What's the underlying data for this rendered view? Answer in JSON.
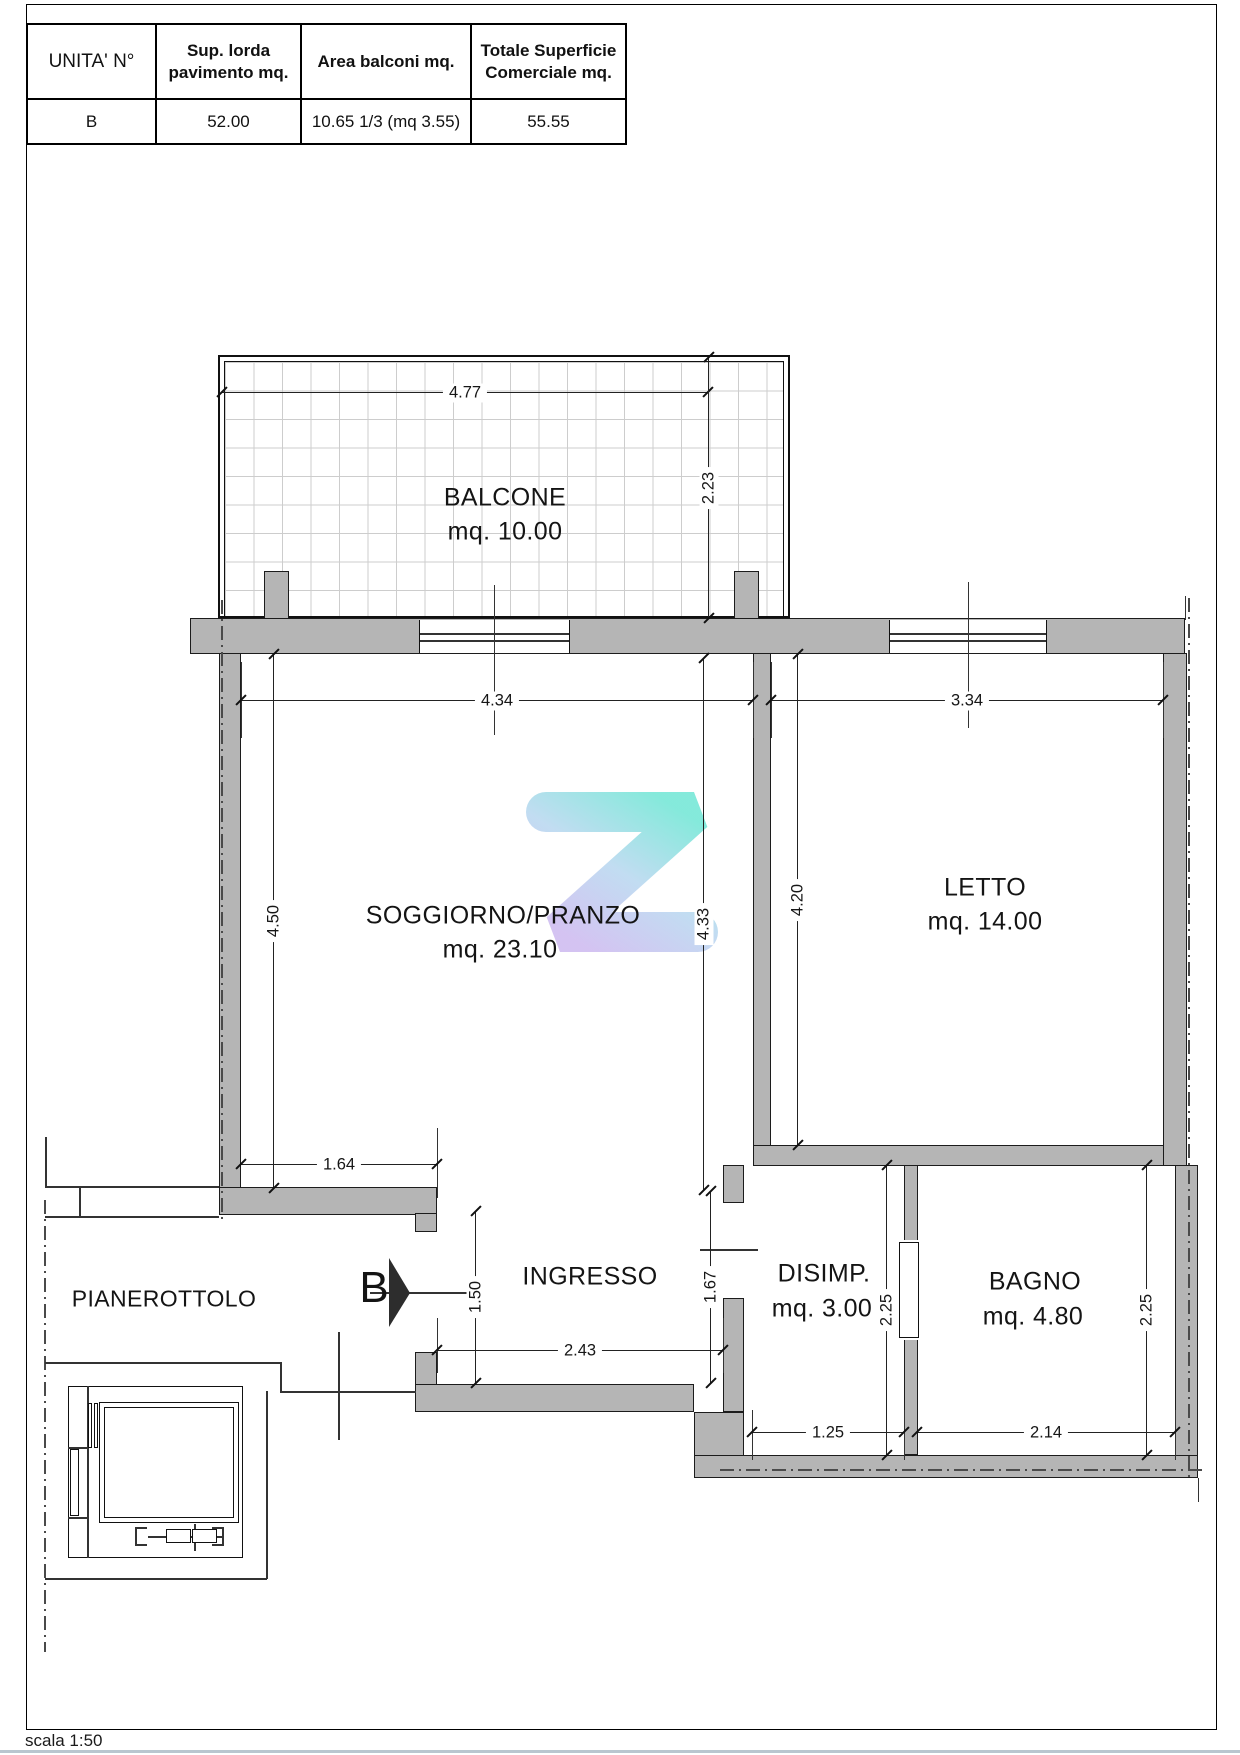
{
  "table": {
    "headers": [
      "UNITA' N°",
      "Sup. lorda pavimento mq.",
      "Area balconi mq.",
      "Totale Superficie Comerciale mq."
    ],
    "row": [
      "B",
      "52.00",
      "10.65  1/3 (mq 3.55)",
      "55.55"
    ]
  },
  "plan": {
    "rooms": {
      "balcone": {
        "name": "BALCONE",
        "area": "mq. 10.00"
      },
      "soggiorno": {
        "name": "SOGGIORNO/PRANZO",
        "area": "mq. 23.10"
      },
      "letto": {
        "name": "LETTO",
        "area": "mq. 14.00"
      },
      "ingresso": {
        "name": "INGRESSO"
      },
      "disimp": {
        "name": "DISIMP.",
        "area": "mq. 3.00"
      },
      "bagno": {
        "name": "BAGNO",
        "area": "mq. 4.80"
      },
      "pianerottolo": {
        "name": "PIANEROTTOLO"
      }
    },
    "dims": {
      "balcone_w": "4.77",
      "balcone_d": "2.23",
      "soggiorno_w": "4.34",
      "letto_w": "3.34",
      "soggiorno_h_left": "4.50",
      "soggiorno_h_right": "4.33",
      "letto_h": "4.20",
      "sogg_wall_bottom": "1.64",
      "entrance_opening": "1.50",
      "ingresso_w": "2.43",
      "ingresso_h": "1.67",
      "disimp_h": "2.25",
      "disimp_w": "1.25",
      "bagno_h": "2.25",
      "bagno_w": "2.14"
    },
    "entrance_label": "B"
  },
  "footer": {
    "scale_label": "scala 1:50"
  },
  "colors": {
    "wall_fill": "#b5b5b5",
    "line": "#1c1c1c",
    "watermark_teal": "#66e4d2",
    "watermark_blue": "#b2d4ee",
    "watermark_purple": "#c9b4ee"
  }
}
